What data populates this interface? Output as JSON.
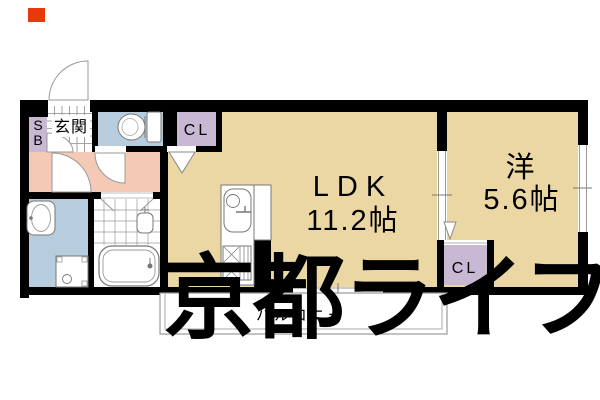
{
  "floor_plan": {
    "watermark_text": "京都ライフ",
    "rooms": {
      "ldk": {
        "label": "LDK",
        "size": "11.2帖"
      },
      "western_room": {
        "label": "洋",
        "size": "5.6帖"
      },
      "entrance": {
        "label": "玄関"
      },
      "balcony": {
        "label": "バルコニー"
      },
      "shoe_box": {
        "line1": "S",
        "line2": "B"
      },
      "closet_ldk": {
        "label": "CL"
      },
      "closet_western": {
        "label": "CL"
      }
    },
    "colors": {
      "room_tan": "#ebd7a3",
      "hallway_pink": "#f4c9b6",
      "wet_area_blue": "#b7ccdd",
      "closet_purple": "#c8b8d3",
      "wall_black": "#000000",
      "tile_white": "#ffffff",
      "watermark_gray": "#ababab",
      "marker_red": "#e8380d"
    },
    "fixtures": [
      "toilet-icon",
      "bathtub-icon",
      "vanity-sink-icon",
      "washer-pan-icon",
      "kitchen-sink-icon",
      "stove-icon"
    ]
  }
}
